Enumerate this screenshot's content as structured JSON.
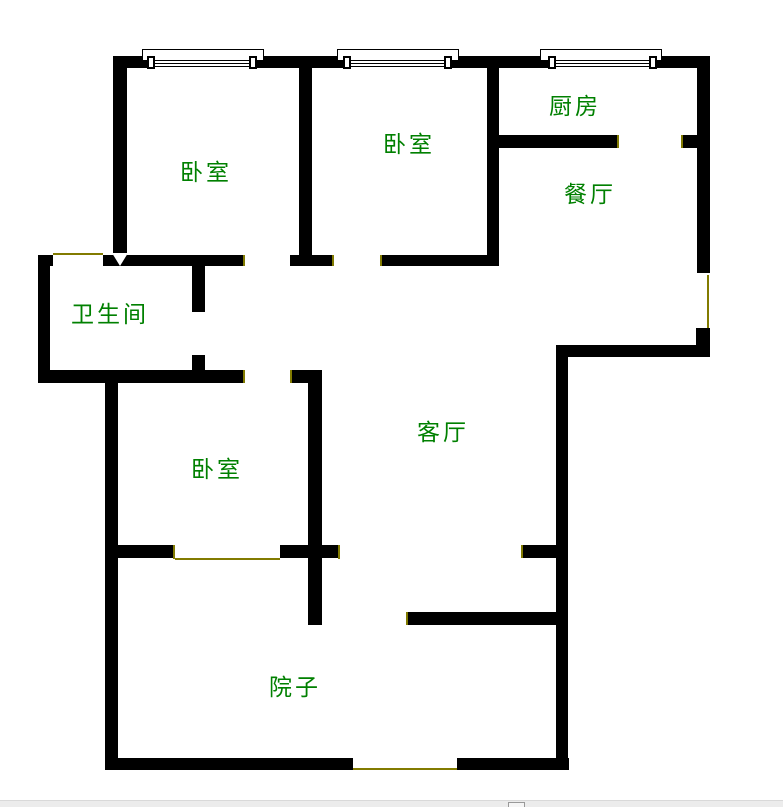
{
  "title": "户型图",
  "colors": {
    "wall": "#000000",
    "opening_marker": "#827b00",
    "room_label": "#008000",
    "background": "#ffffff",
    "statusbar_bg": "#ececec"
  },
  "rooms": {
    "bedroom_top_left": {
      "label": "卧室"
    },
    "bedroom_top_middle": {
      "label": "卧室"
    },
    "kitchen": {
      "label": "厨房"
    },
    "dining_room": {
      "label": "餐厅"
    },
    "bathroom": {
      "label": "卫生间"
    },
    "living_room": {
      "label": "客厅"
    },
    "bedroom_lower_left": {
      "label": "卧室"
    },
    "yard": {
      "label": "院子"
    }
  },
  "floorplan": {
    "walls": [
      [
        113,
        56,
        34,
        12
      ],
      [
        257,
        56,
        86,
        12
      ],
      [
        452,
        56,
        96,
        12
      ],
      [
        657,
        56,
        53,
        12
      ],
      [
        697,
        56,
        13,
        217
      ],
      [
        696,
        328,
        14,
        29
      ],
      [
        556,
        345,
        154,
        12
      ],
      [
        556,
        345,
        12,
        425
      ],
      [
        105,
        758,
        248,
        12
      ],
      [
        457,
        758,
        112,
        12
      ],
      [
        105,
        382,
        13,
        388
      ],
      [
        38,
        255,
        12,
        128
      ],
      [
        38,
        255,
        15,
        11
      ],
      [
        103,
        255,
        142,
        11
      ],
      [
        290,
        255,
        42,
        11
      ],
      [
        380,
        255,
        117,
        11
      ],
      [
        113,
        56,
        14,
        199
      ],
      [
        299,
        68,
        13,
        187
      ],
      [
        487,
        68,
        12,
        198
      ],
      [
        499,
        135,
        118,
        13
      ],
      [
        683,
        135,
        14,
        13
      ],
      [
        192,
        266,
        13,
        46
      ],
      [
        192,
        355,
        13,
        15
      ],
      [
        38,
        370,
        207,
        13
      ],
      [
        292,
        370,
        30,
        13
      ],
      [
        308,
        383,
        14,
        242
      ],
      [
        118,
        545,
        55,
        13
      ],
      [
        280,
        545,
        58,
        13
      ],
      [
        523,
        545,
        33,
        13
      ],
      [
        408,
        612,
        148,
        13
      ]
    ],
    "openings": [
      [
        53,
        253,
        50,
        2
      ],
      [
        243,
        255,
        2,
        11
      ],
      [
        332,
        255,
        2,
        11
      ],
      [
        380,
        255,
        2,
        11
      ],
      [
        617,
        135,
        2,
        13
      ],
      [
        681,
        135,
        2,
        13
      ],
      [
        243,
        370,
        2,
        13
      ],
      [
        290,
        370,
        2,
        13
      ],
      [
        173,
        545,
        2,
        14
      ],
      [
        175,
        558,
        105,
        2
      ],
      [
        338,
        545,
        2,
        14
      ],
      [
        521,
        545,
        2,
        13
      ],
      [
        406,
        612,
        2,
        13
      ],
      [
        353,
        768,
        104,
        2
      ],
      [
        707,
        275,
        2,
        53
      ]
    ],
    "windows": [
      {
        "frame": [
          142,
          49,
          120,
          10
        ],
        "open_x": 147,
        "open_w": 110
      },
      {
        "frame": [
          337,
          49,
          120,
          10
        ],
        "open_x": 343,
        "open_w": 109
      },
      {
        "frame": [
          540,
          49,
          120,
          10
        ],
        "open_x": 548,
        "open_w": 109
      }
    ]
  }
}
